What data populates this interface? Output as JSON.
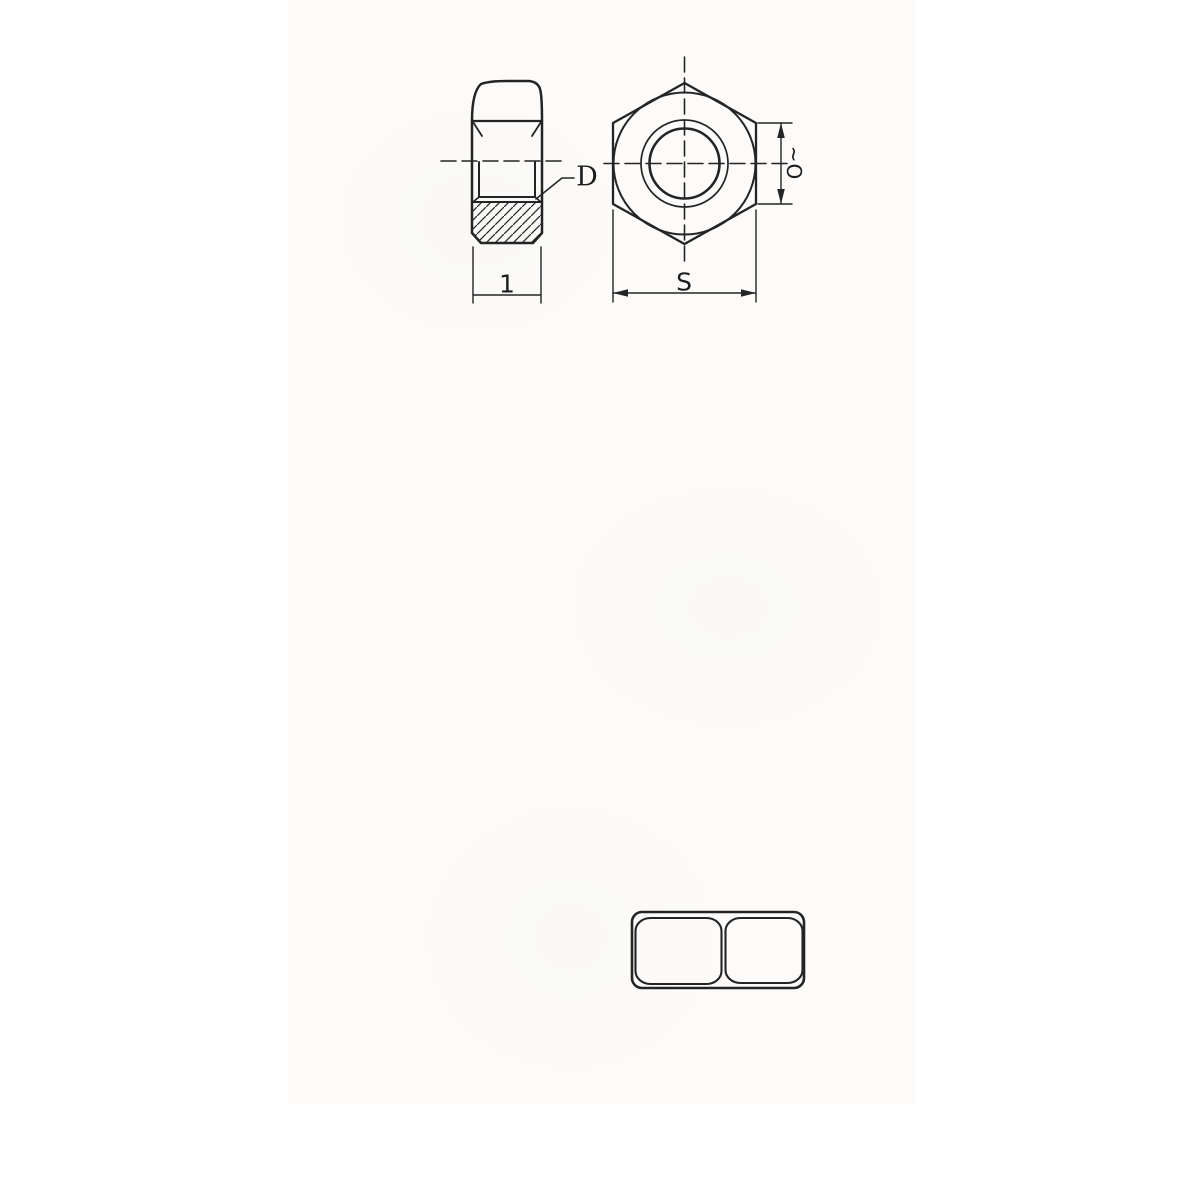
{
  "drawing": {
    "ink_color": "#242424",
    "paper_color": "#fcfbf9",
    "labels": {
      "thread_callout": "D",
      "height_dimension": "1",
      "across_flats_dimension": "S",
      "chamfer_dimension_rotated": "~O"
    }
  }
}
